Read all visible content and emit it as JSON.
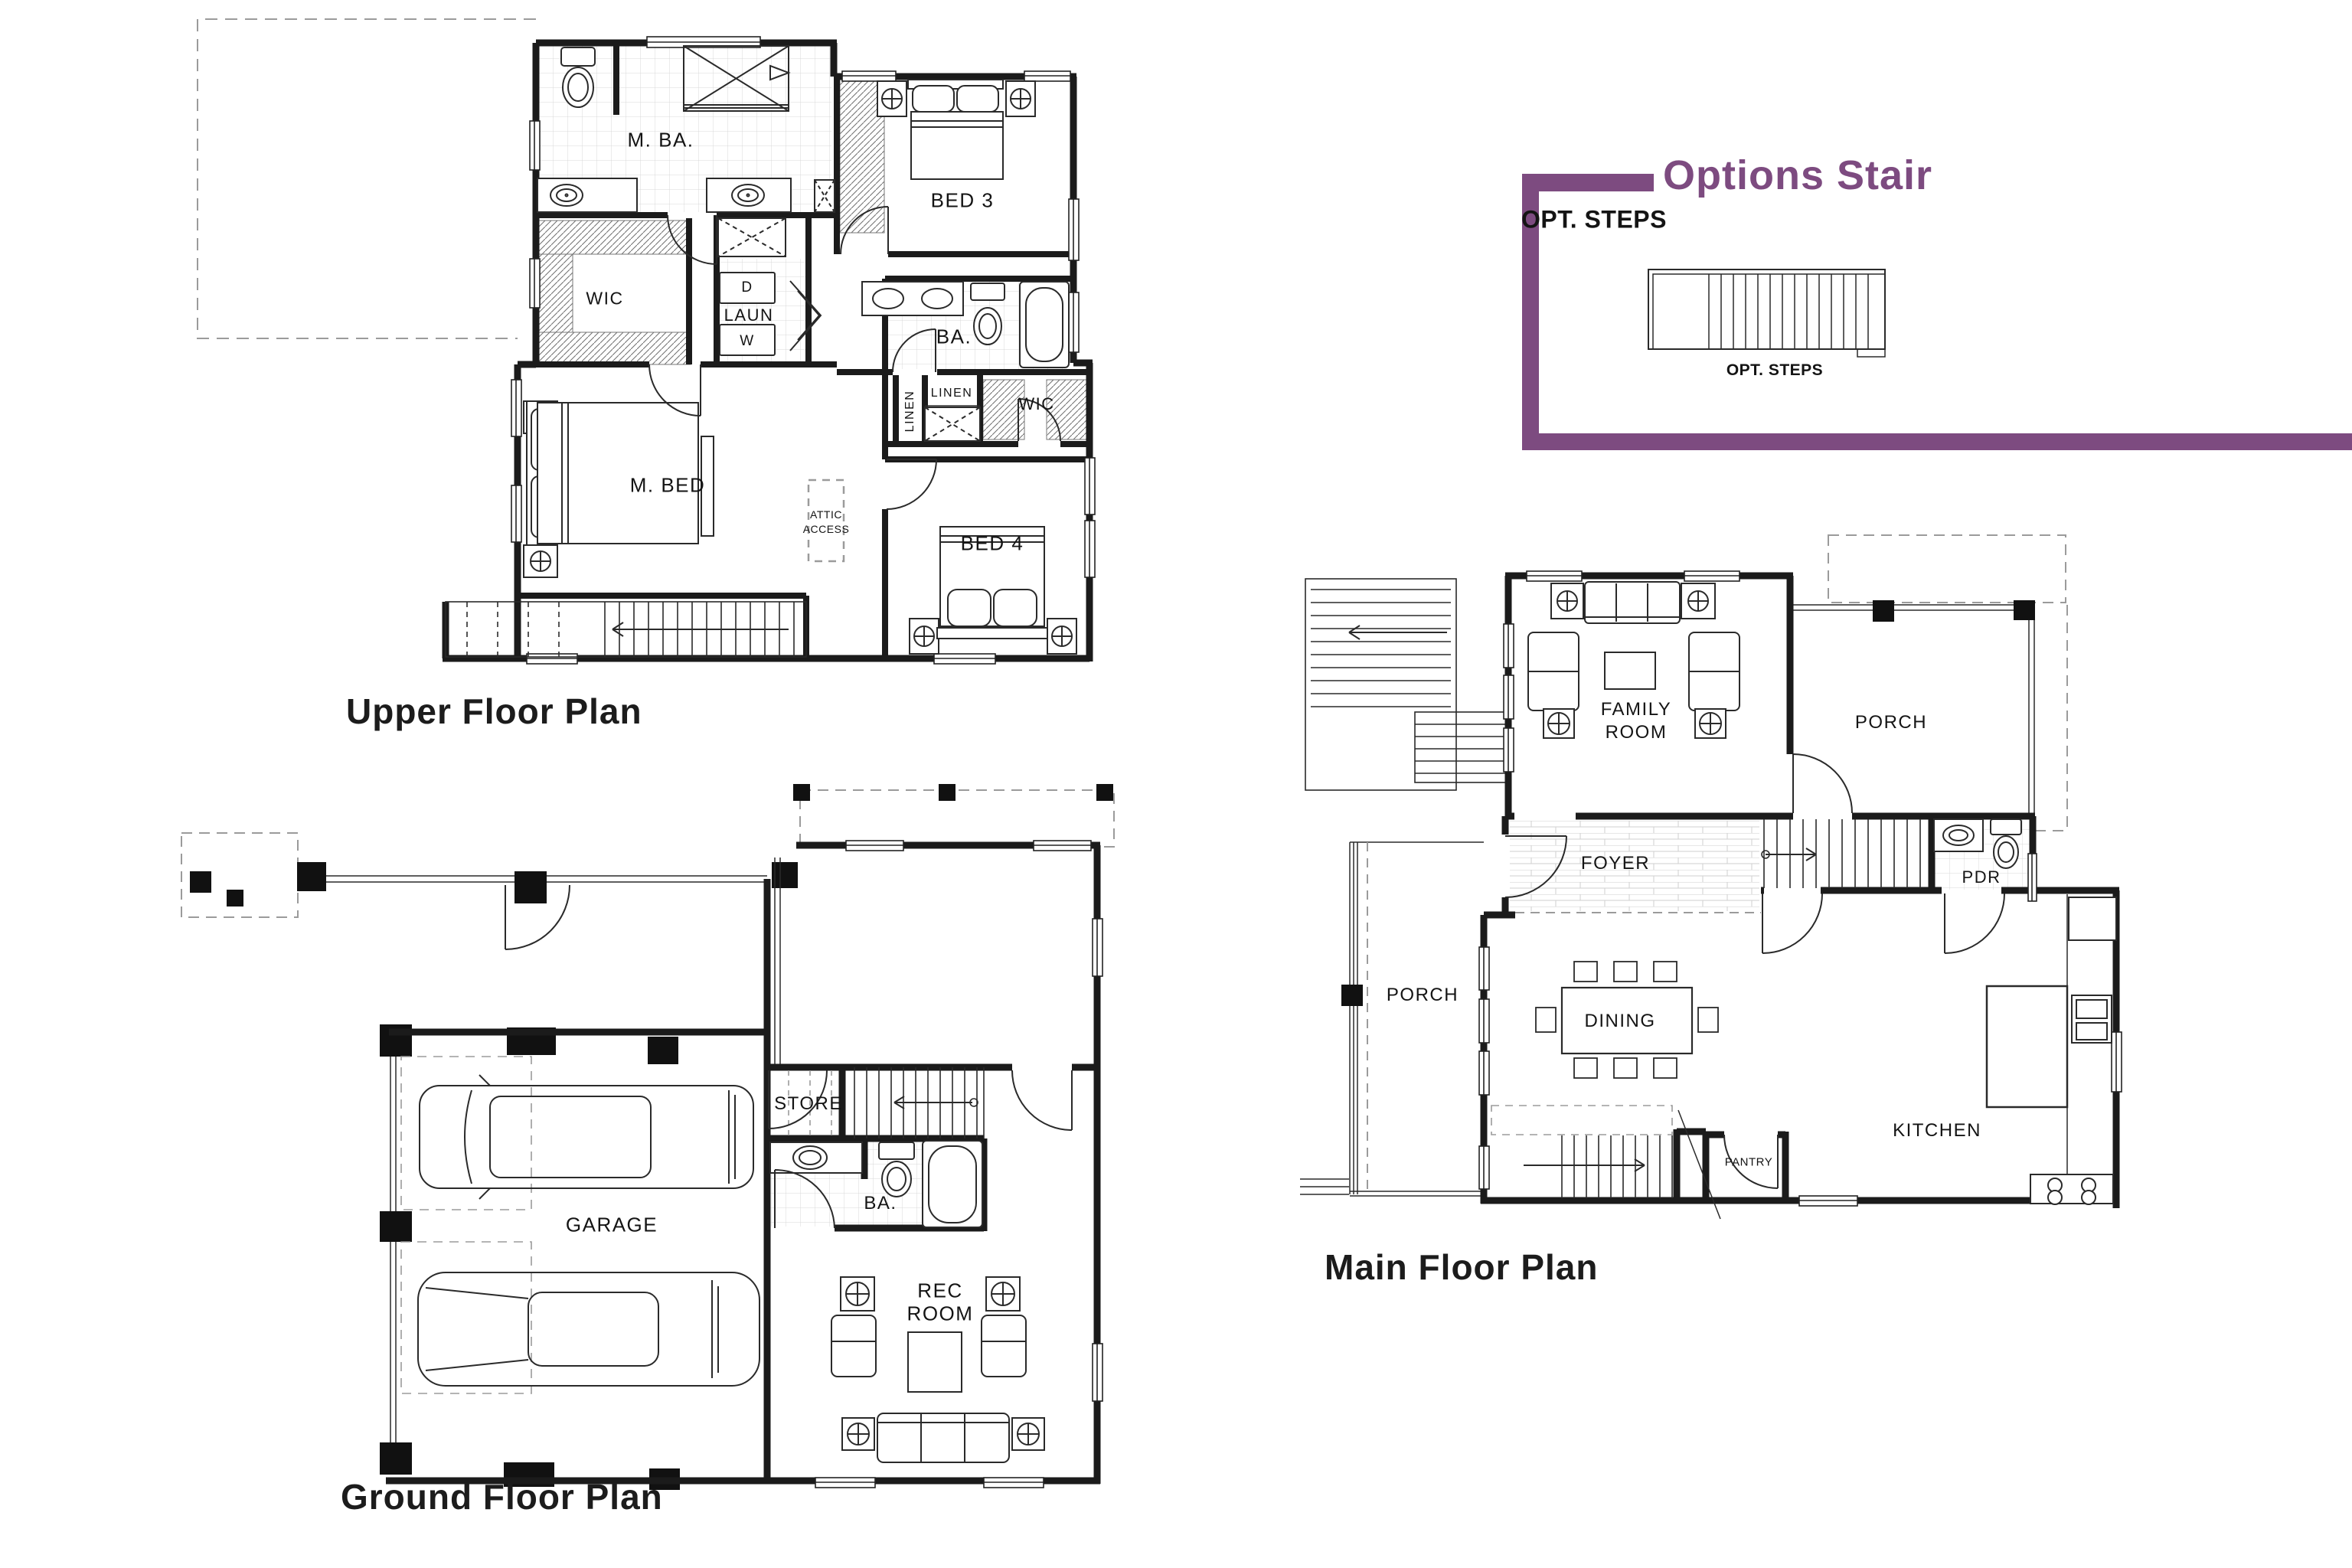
{
  "colors": {
    "accent_purple": "#7d4b80",
    "line": "#1b1b1b"
  },
  "titles": {
    "upper": "Upper Floor Plan",
    "ground": "Ground Floor Plan",
    "main": "Main Floor Plan",
    "options": "Options Stair"
  },
  "options": {
    "header": "OPT. STEPS",
    "caption": "OPT. STEPS"
  },
  "upper": {
    "m_ba": "M. BA.",
    "wic_left": "WIC",
    "dryer": "D",
    "laundry": "LAUN",
    "washer": "W",
    "bed3": "BED 3",
    "bath": "BA.",
    "linen_vertical": "LINEN",
    "linen_horizontal": "LINEN",
    "wic_right": "WIC",
    "m_bed": "M. BED",
    "attic_line1": "ATTIC",
    "attic_line2": "ACCESS",
    "bed4": "BED 4"
  },
  "ground": {
    "store": "STORE",
    "bath": "BA.",
    "garage": "GARAGE",
    "rec_line1": "REC",
    "rec_line2": "ROOM"
  },
  "main": {
    "family_line1": "FAMILY",
    "family_line2": "ROOM",
    "porch_right": "PORCH",
    "foyer": "FOYER",
    "powder": "PDR",
    "porch_left": "PORCH",
    "dining": "DINING",
    "kitchen": "KITCHEN",
    "pantry": "PANTRY"
  }
}
